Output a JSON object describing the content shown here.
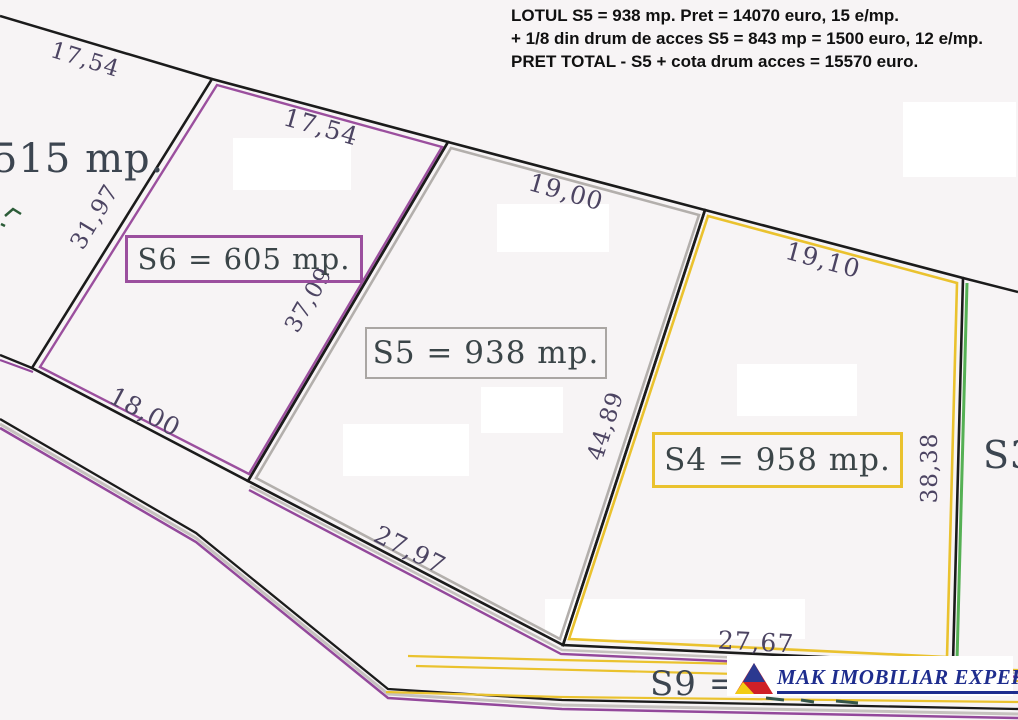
{
  "annotation": {
    "lines": [
      "LOTUL S5 = 938 mp. Pret = 14070 euro, 15 e/mp.",
      "+ 1/8 din drum de acces S5 = 843 mp = 1500 euro, 12 e/mp.",
      "PRET TOTAL - S5 + cota drum acces = 15570 euro."
    ]
  },
  "plots": {
    "s6": {
      "label": "S6 = 605 mp.",
      "border_color": "#9b4f9e"
    },
    "s5": {
      "label": "S5 = 938 mp.",
      "border_color": "#aaa6a3"
    },
    "s4": {
      "label": "S4 = 958 mp.",
      "border_color": "#eac22e"
    },
    "s3": {
      "label": "S3"
    },
    "s9": {
      "label": "S9 ="
    },
    "left_neighbor": {
      "label": "515 mp."
    }
  },
  "dimensions": [
    "17,54",
    "17,54",
    "19,00",
    "19,10",
    "31,97",
    "37,09",
    "44,89",
    "38,38",
    "18,00",
    "27,97",
    "27,67"
  ],
  "logo": {
    "company": "MAK IMOBILIAR EXPERT",
    "triangle_colors": {
      "blue": "#2b3990",
      "red": "#cf2027",
      "yellow": "#f2cd13"
    }
  },
  "colors": {
    "boundary": "#1b1b1b",
    "purple": "#9b4f9e",
    "gray": "#b3afac",
    "yellow": "#eac22e",
    "green": "#55b054",
    "road_purple": "#93489b",
    "covered_text": "#355548"
  }
}
